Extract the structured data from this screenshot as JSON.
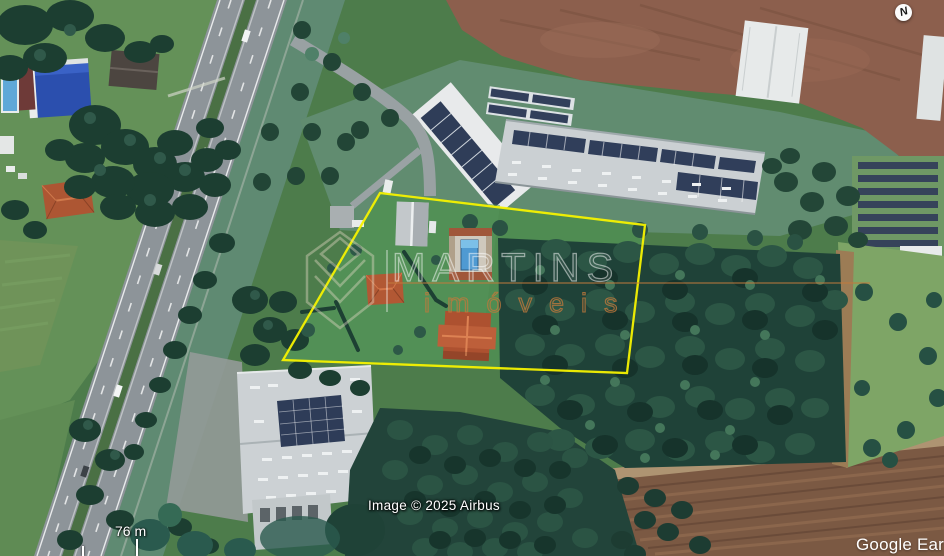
{
  "overlay": {
    "compass_label": "N",
    "scale_bar": {
      "label": "76 m"
    },
    "attribution": "Image © 2025 Airbus",
    "google_logo": "Google Ear",
    "text_color": "#ffffff"
  },
  "boundary": {
    "color": "#f6f200",
    "points": [
      [
        380,
        193
      ],
      [
        645,
        225
      ],
      [
        627,
        373
      ],
      [
        283,
        360
      ]
    ]
  },
  "watermark": {
    "brand_top": "MARTINS",
    "brand_bottom": "imóveis",
    "accent_color": "#c1793c",
    "outline_color": "#ffffff"
  }
}
